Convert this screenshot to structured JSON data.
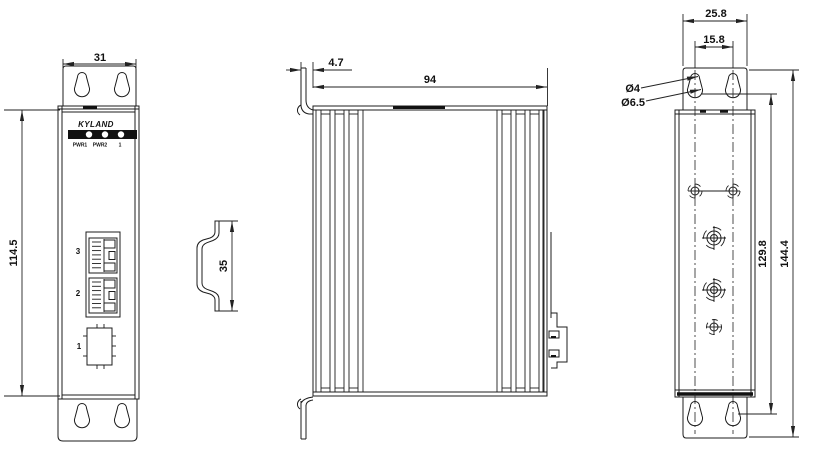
{
  "drawing": {
    "brand": "KYLAND",
    "front_view": {
      "dim_width": "31",
      "dim_height": "114.5",
      "led_labels": {
        "pwr1": "PWR1",
        "pwr2": "PWR2",
        "port": "1"
      },
      "port_labels": {
        "rj45_top": "3",
        "rj45_bottom": "2",
        "sfp": "1"
      }
    },
    "din_rail": {
      "dim_height": "35"
    },
    "side_view": {
      "dim_flange": "4.7",
      "dim_depth": "94"
    },
    "back_view": {
      "dim_plate_width": "25.8",
      "dim_hole_spacing": "15.8",
      "dim_small_hole": "Ø4",
      "dim_large_hole": "Ø6.5",
      "dim_hole_span": "129.8",
      "dim_overall_height": "144.4"
    }
  }
}
